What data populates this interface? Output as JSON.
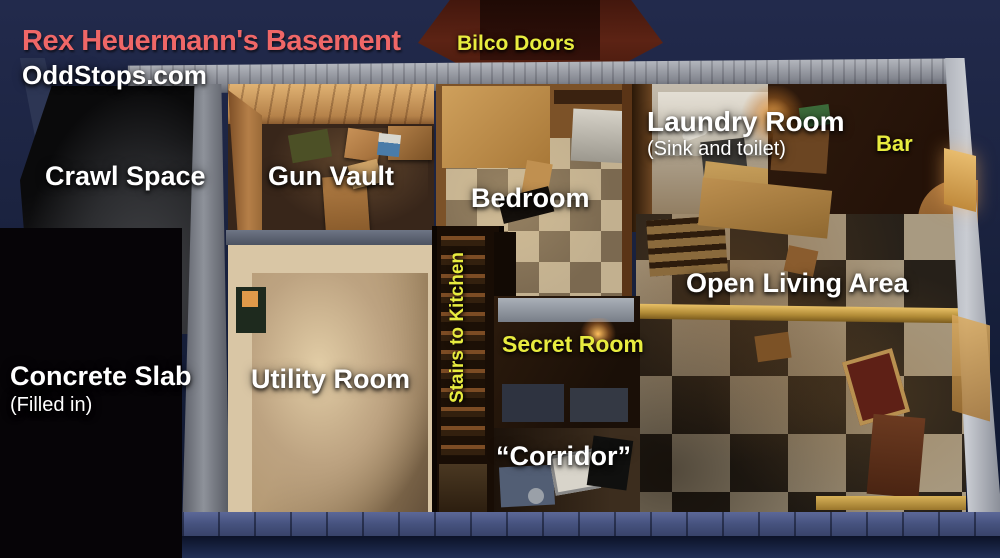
{
  "header": {
    "title": "Rex Heuermann's Basement",
    "website": "OddStops.com"
  },
  "labels": {
    "bilco_doors": "Bilco Doors",
    "crawl_space": "Crawl Space",
    "gun_vault": "Gun Vault",
    "bedroom": "Bedroom",
    "laundry_room": "Laundry Room",
    "laundry_room_note": "(Sink and toilet)",
    "bar": "Bar",
    "open_living_area": "Open Living Area",
    "stairs_to_kitchen": "Stairs to Kitchen",
    "secret_room": "Secret Room",
    "utility_room": "Utility Room",
    "concrete_slab": "Concrete Slab",
    "concrete_slab_note": "(Filled in)",
    "corridor": "“Corridor”"
  },
  "colors": {
    "title_red": "#ef6767",
    "label_white": "#ffffff",
    "label_yellow": "#e8ec3f",
    "background_navy": "#1b2340",
    "foundation_blue": "#46527e",
    "concrete_gray": "#9b9fa8"
  }
}
